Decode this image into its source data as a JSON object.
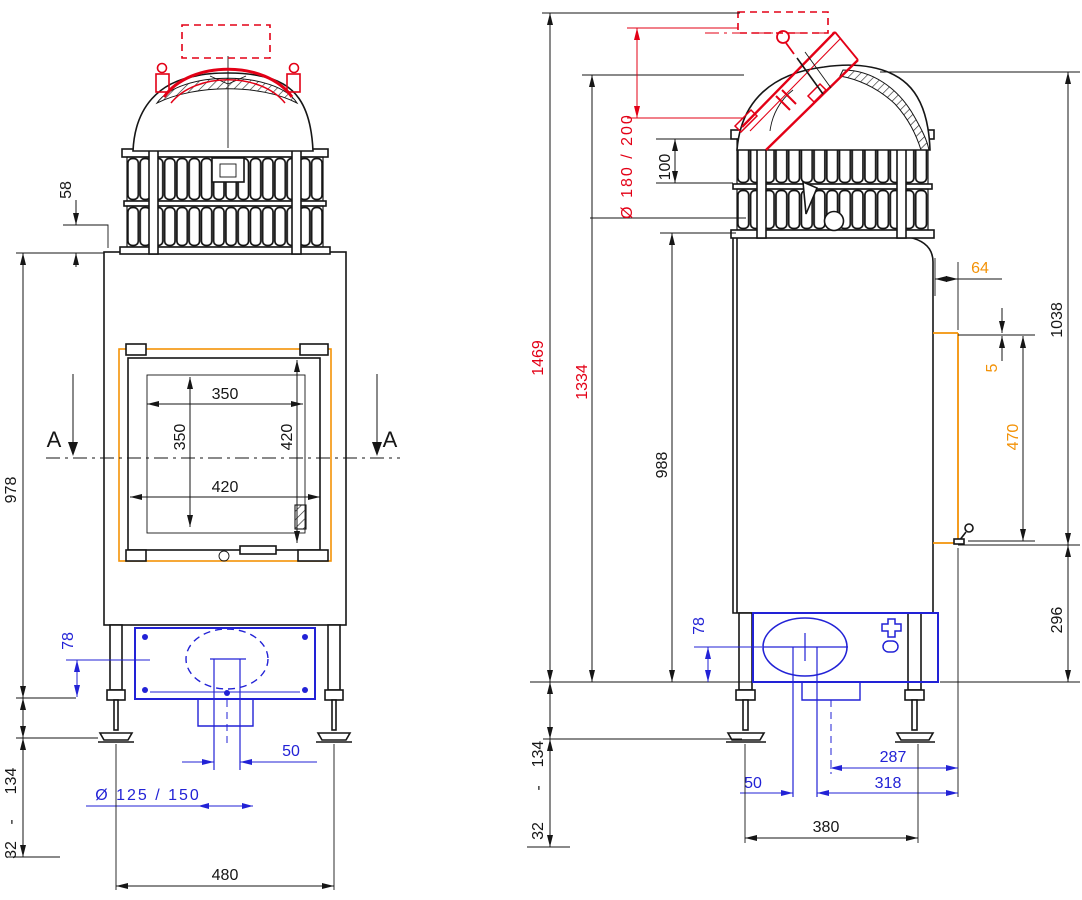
{
  "front_view": {
    "section_marker": "A",
    "dims": {
      "fin_to_body": "58",
      "body_height": "978",
      "leg_range_max": "134",
      "range_separator": "-",
      "leg_range_min": "32",
      "glass_width": "350",
      "glass_height": "350",
      "door_width": "420",
      "door_height": "420",
      "base_axis_offset": "78",
      "duct_offset": "50",
      "inlet_diameter": "Ø 125 / 150",
      "leg_spacing": "480"
    }
  },
  "side_view": {
    "dims": {
      "total_height": "1469",
      "collar_height": "1334",
      "body_height": "988",
      "fin_section": "100",
      "flue_diameter": "Ø 180 / 200",
      "frame_depth": "64",
      "frame_gap": "5",
      "door_frame_height": "470",
      "dome_height": "1038",
      "base_zone_height": "296",
      "base_axis_offset": "78",
      "leg_range_max": "134",
      "range_separator": "-",
      "leg_range_min": "32",
      "duct_center_to_front": "287",
      "duct_width": "50",
      "duct_to_front": "318",
      "leg_spacing": "380"
    }
  },
  "colors": {
    "line": "#161616",
    "red": "#e30016",
    "blue": "#2222d6",
    "orange": "#f39207"
  }
}
